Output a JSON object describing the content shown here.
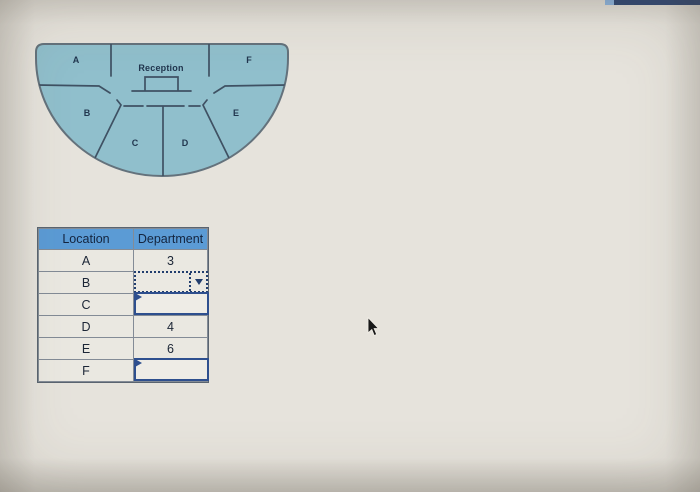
{
  "page": {
    "background_color": "#e6e3dc",
    "top_strip_color": "#2f4877",
    "top_strip_accent_color": "#8fb7e4"
  },
  "floor_plan": {
    "fill_color": "#90bfcc",
    "outline_color": "#64727c",
    "wall_color": "#3f5163",
    "reception_label": "Reception",
    "rooms": [
      {
        "label": "A"
      },
      {
        "label": "B"
      },
      {
        "label": "C"
      },
      {
        "label": "D"
      },
      {
        "label": "E"
      },
      {
        "label": "F"
      }
    ]
  },
  "table": {
    "header_bg": "#5b9bd5",
    "columns": [
      "Location",
      "Department"
    ],
    "rows": [
      {
        "location": "A",
        "department": "3",
        "field": "value"
      },
      {
        "location": "B",
        "department": "",
        "field": "dropdown-focused"
      },
      {
        "location": "C",
        "department": "",
        "field": "dropdown-empty"
      },
      {
        "location": "D",
        "department": "4",
        "field": "value"
      },
      {
        "location": "E",
        "department": "6",
        "field": "value"
      },
      {
        "location": "F",
        "department": "",
        "field": "dropdown-empty"
      }
    ]
  },
  "cursor": {
    "type": "arrow-pointer"
  }
}
